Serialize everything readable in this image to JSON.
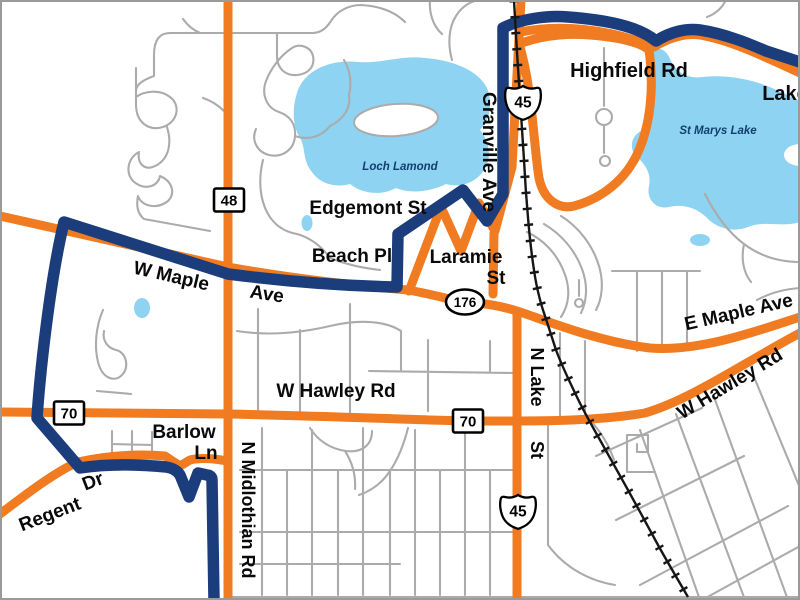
{
  "map": {
    "type": "street-map",
    "colors": {
      "background": "#ffffff",
      "route_primary_orange": "#f07b21",
      "route_secondary_navy": "#1b3d7c",
      "water": "#8ed3f2",
      "minor_road": "#ababab",
      "railroad": "#161616",
      "road_label": "#0a0a0a",
      "water_label": "#123f6e",
      "shield_fill": "#ffffff",
      "shield_border": "#000000",
      "frame": "#9a9a9a"
    },
    "road_labels": [
      {
        "id": "highfield-rd",
        "text": "Highfield Rd",
        "x": 629,
        "y": 77,
        "size": 20,
        "rotate": 0
      },
      {
        "id": "lake-edge",
        "text": "Lake",
        "x": 785,
        "y": 100,
        "size": 20,
        "rotate": 0
      },
      {
        "id": "granville-ave",
        "text": "Granville Ave",
        "x": 483,
        "y": 152,
        "size": 19,
        "rotate": 90
      },
      {
        "id": "edgemont-st",
        "text": "Edgemont St",
        "x": 368,
        "y": 214,
        "size": 19,
        "rotate": 0
      },
      {
        "id": "beach-pl",
        "text": "Beach Pl",
        "x": 352,
        "y": 262,
        "size": 19,
        "rotate": 0
      },
      {
        "id": "laramie",
        "text": "Laramie",
        "x": 466,
        "y": 263,
        "size": 19,
        "rotate": 0
      },
      {
        "id": "laramie-st",
        "text": "St",
        "x": 496,
        "y": 284,
        "size": 19,
        "rotate": 0
      },
      {
        "id": "w-maple",
        "text": "W Maple",
        "x": 170,
        "y": 282,
        "size": 19,
        "rotate": 13
      },
      {
        "id": "w-maple-ave",
        "text": "Ave",
        "x": 266,
        "y": 300,
        "size": 19,
        "rotate": 9
      },
      {
        "id": "e-maple-ave",
        "text": "E Maple Ave",
        "x": 740,
        "y": 318,
        "size": 19,
        "rotate": -13
      },
      {
        "id": "w-hawley-rd-west",
        "text": "W Hawley Rd",
        "x": 336,
        "y": 397,
        "size": 19,
        "rotate": 0
      },
      {
        "id": "w-hawley-rd-east",
        "text": "W Hawley Rd",
        "x": 733,
        "y": 389,
        "size": 19,
        "rotate": -31
      },
      {
        "id": "n-lake",
        "text": "N Lake",
        "x": 531,
        "y": 377,
        "size": 18,
        "rotate": 90
      },
      {
        "id": "n-lake-st",
        "text": "St",
        "x": 531,
        "y": 450,
        "size": 18,
        "rotate": 90
      },
      {
        "id": "barlow",
        "text": "Barlow",
        "x": 184,
        "y": 438,
        "size": 19,
        "rotate": 0
      },
      {
        "id": "barlow-ln",
        "text": "Ln",
        "x": 206,
        "y": 459,
        "size": 19,
        "rotate": 0
      },
      {
        "id": "n-midlothian-rd",
        "text": "N Midlothian Rd",
        "x": 242,
        "y": 510,
        "size": 18,
        "rotate": 90
      },
      {
        "id": "regent",
        "text": "Regent",
        "x": 52,
        "y": 520,
        "size": 19,
        "rotate": -21
      },
      {
        "id": "regent-dr",
        "text": "Dr",
        "x": 95,
        "y": 487,
        "size": 19,
        "rotate": -21
      }
    ],
    "water_labels": [
      {
        "id": "loch-lamond",
        "text": "Loch Lamond",
        "x": 400,
        "y": 170,
        "size": 11.5
      },
      {
        "id": "st-marys-lake",
        "text": "St Marys Lake",
        "x": 718,
        "y": 134,
        "size": 11.5
      }
    ],
    "shields": [
      {
        "type": "square",
        "number": "48",
        "x": 229,
        "y": 200
      },
      {
        "type": "square",
        "number": "70",
        "x": 69,
        "y": 413
      },
      {
        "type": "square",
        "number": "70",
        "x": 468,
        "y": 421
      },
      {
        "type": "oval",
        "number": "176",
        "x": 465,
        "y": 302
      },
      {
        "type": "us",
        "number": "45",
        "x": 523,
        "y": 102
      },
      {
        "type": "us",
        "number": "45",
        "x": 518,
        "y": 511
      }
    ]
  }
}
